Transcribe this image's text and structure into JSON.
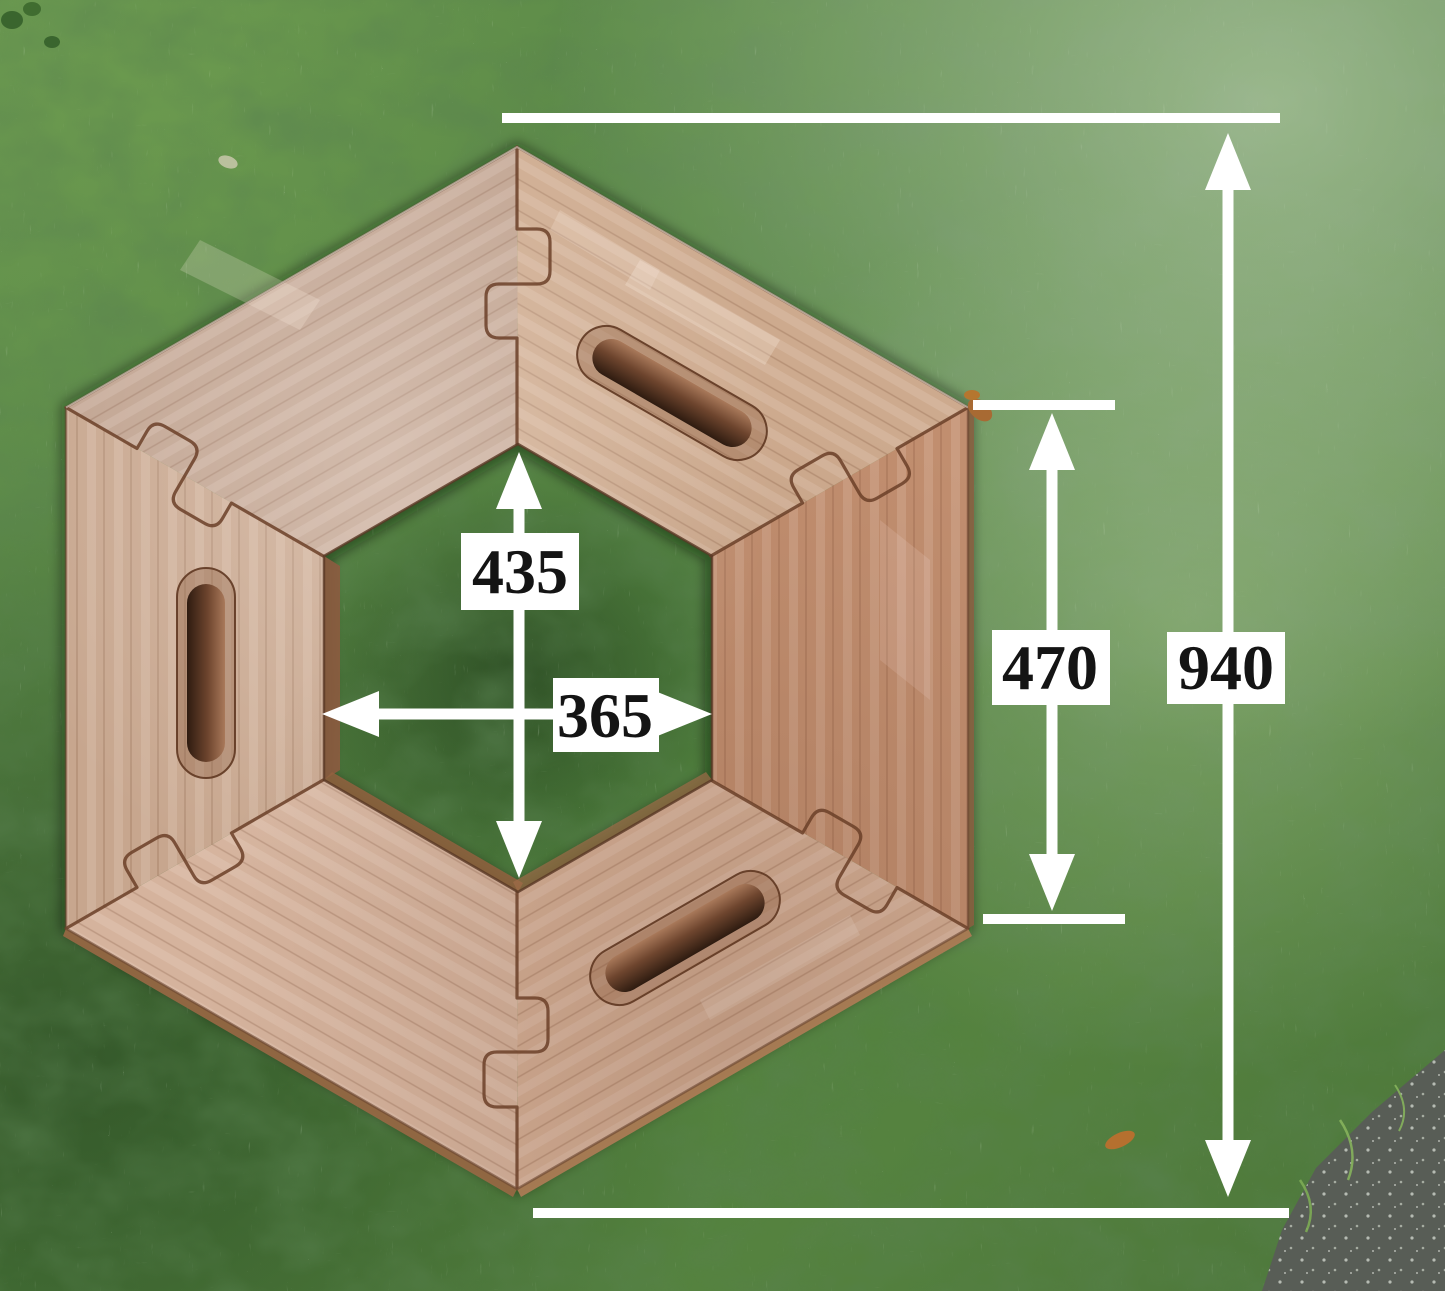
{
  "scene": {
    "subject": "Hexagonal interlocking wooden table ring photographed from above on a lawn",
    "pieces": 6,
    "handle_slots": 3,
    "ground": "grass with light frost; asphalt in bottom-right corner"
  },
  "dimensions": {
    "inner_height_label": "435",
    "inner_width_label": "365",
    "right_span_label": "470",
    "overall_label": "940"
  },
  "colors": {
    "dimension_lines": "#ffffff",
    "label_background": "#ffffff",
    "label_text": "#141414",
    "wood_light": "#d5b39d",
    "wood_mid": "#c49a7e",
    "wood_edge_dark": "#6b4028",
    "grass_green": "#57833f",
    "asphalt_gray": "#585d56"
  }
}
